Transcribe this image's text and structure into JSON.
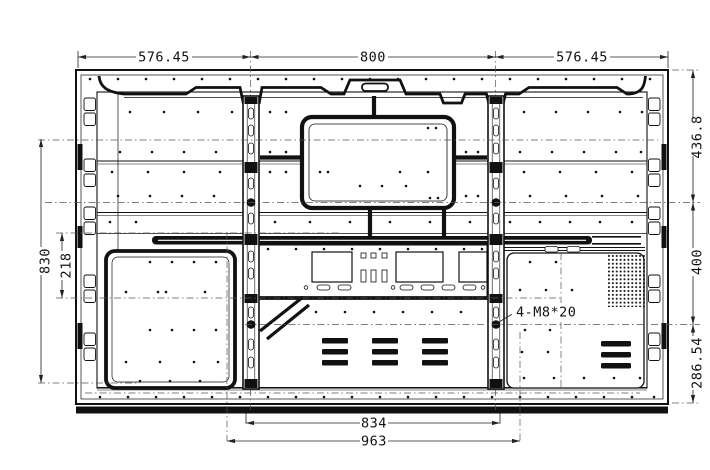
{
  "dimensions": {
    "top": [
      "576.45",
      "800",
      "576.45"
    ],
    "right": [
      "436.8",
      "400",
      "286.54"
    ],
    "left": [
      "830",
      "218"
    ],
    "bottom": [
      "834",
      "963"
    ],
    "annotation": "4-M8*20"
  },
  "colors": {
    "line": "#111111",
    "dimension": "#222222",
    "background": "#ffffff"
  }
}
